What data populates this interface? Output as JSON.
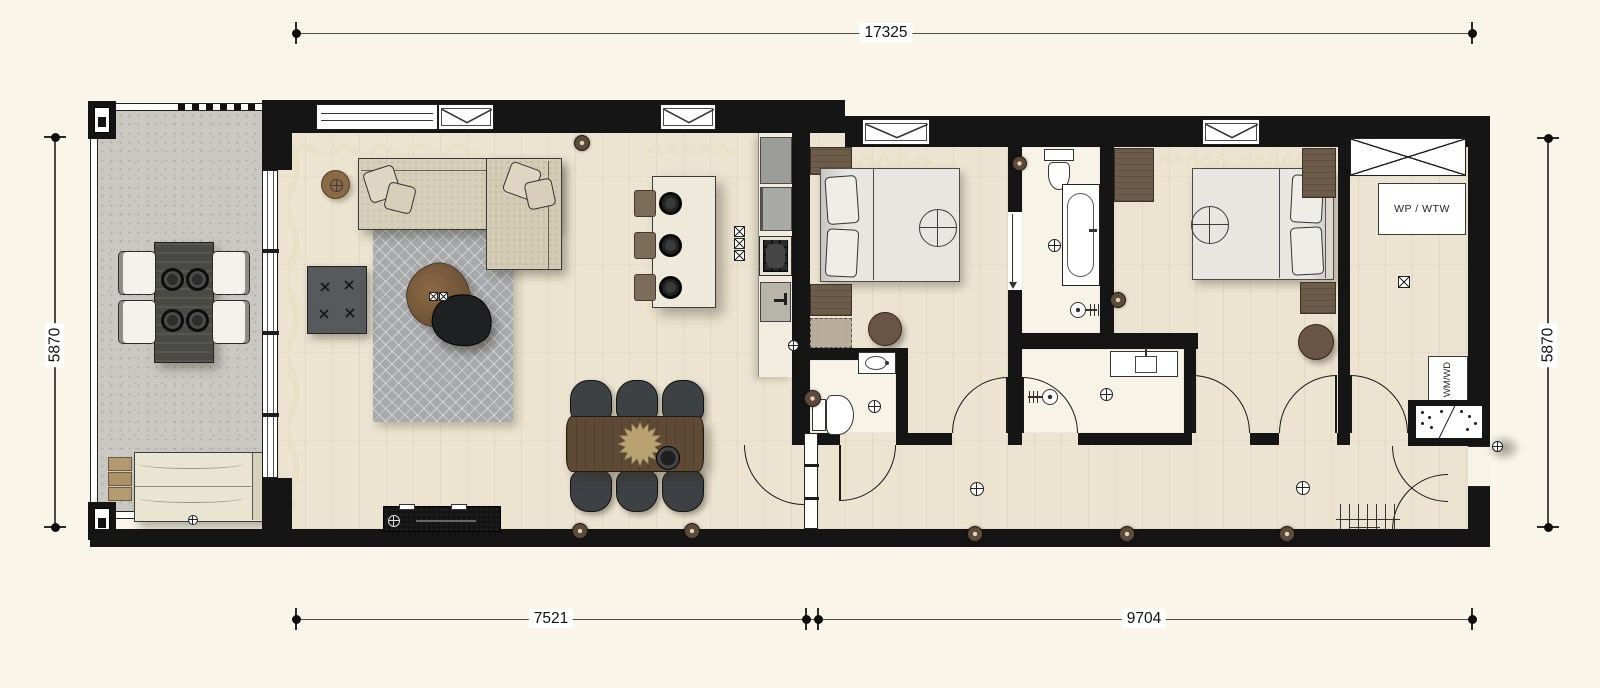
{
  "document": {
    "type": "apartment floor plan, top view"
  },
  "dimensions": {
    "top": {
      "label": "17325"
    },
    "left": {
      "label": "5870"
    },
    "right": {
      "label": "5870"
    },
    "bottom_left": {
      "label": "7521"
    },
    "bottom_right": {
      "label": "9704"
    }
  },
  "technical_room": {
    "heat_unit_label": "WP / WTW",
    "washer_dryer_label": "WM/WD"
  },
  "symbols": {
    "floor_drain": "circle-cross",
    "ventilation_point": "box-with-x",
    "duct_shaft": "crossed-rectangle",
    "ceiling_light": "large-circle-cross",
    "downlight": "brown-dot"
  },
  "colors": {
    "paper": "#f9f5e9",
    "wall": "#151515",
    "wood_floor": "#ece3d0",
    "bath_floor": "#f7f3e6",
    "balcony_floor": "#c9c8c3",
    "wood_furniture": "#6e5c4a",
    "rug": "#a7a9ab",
    "curtain": "#e9e0c8"
  }
}
